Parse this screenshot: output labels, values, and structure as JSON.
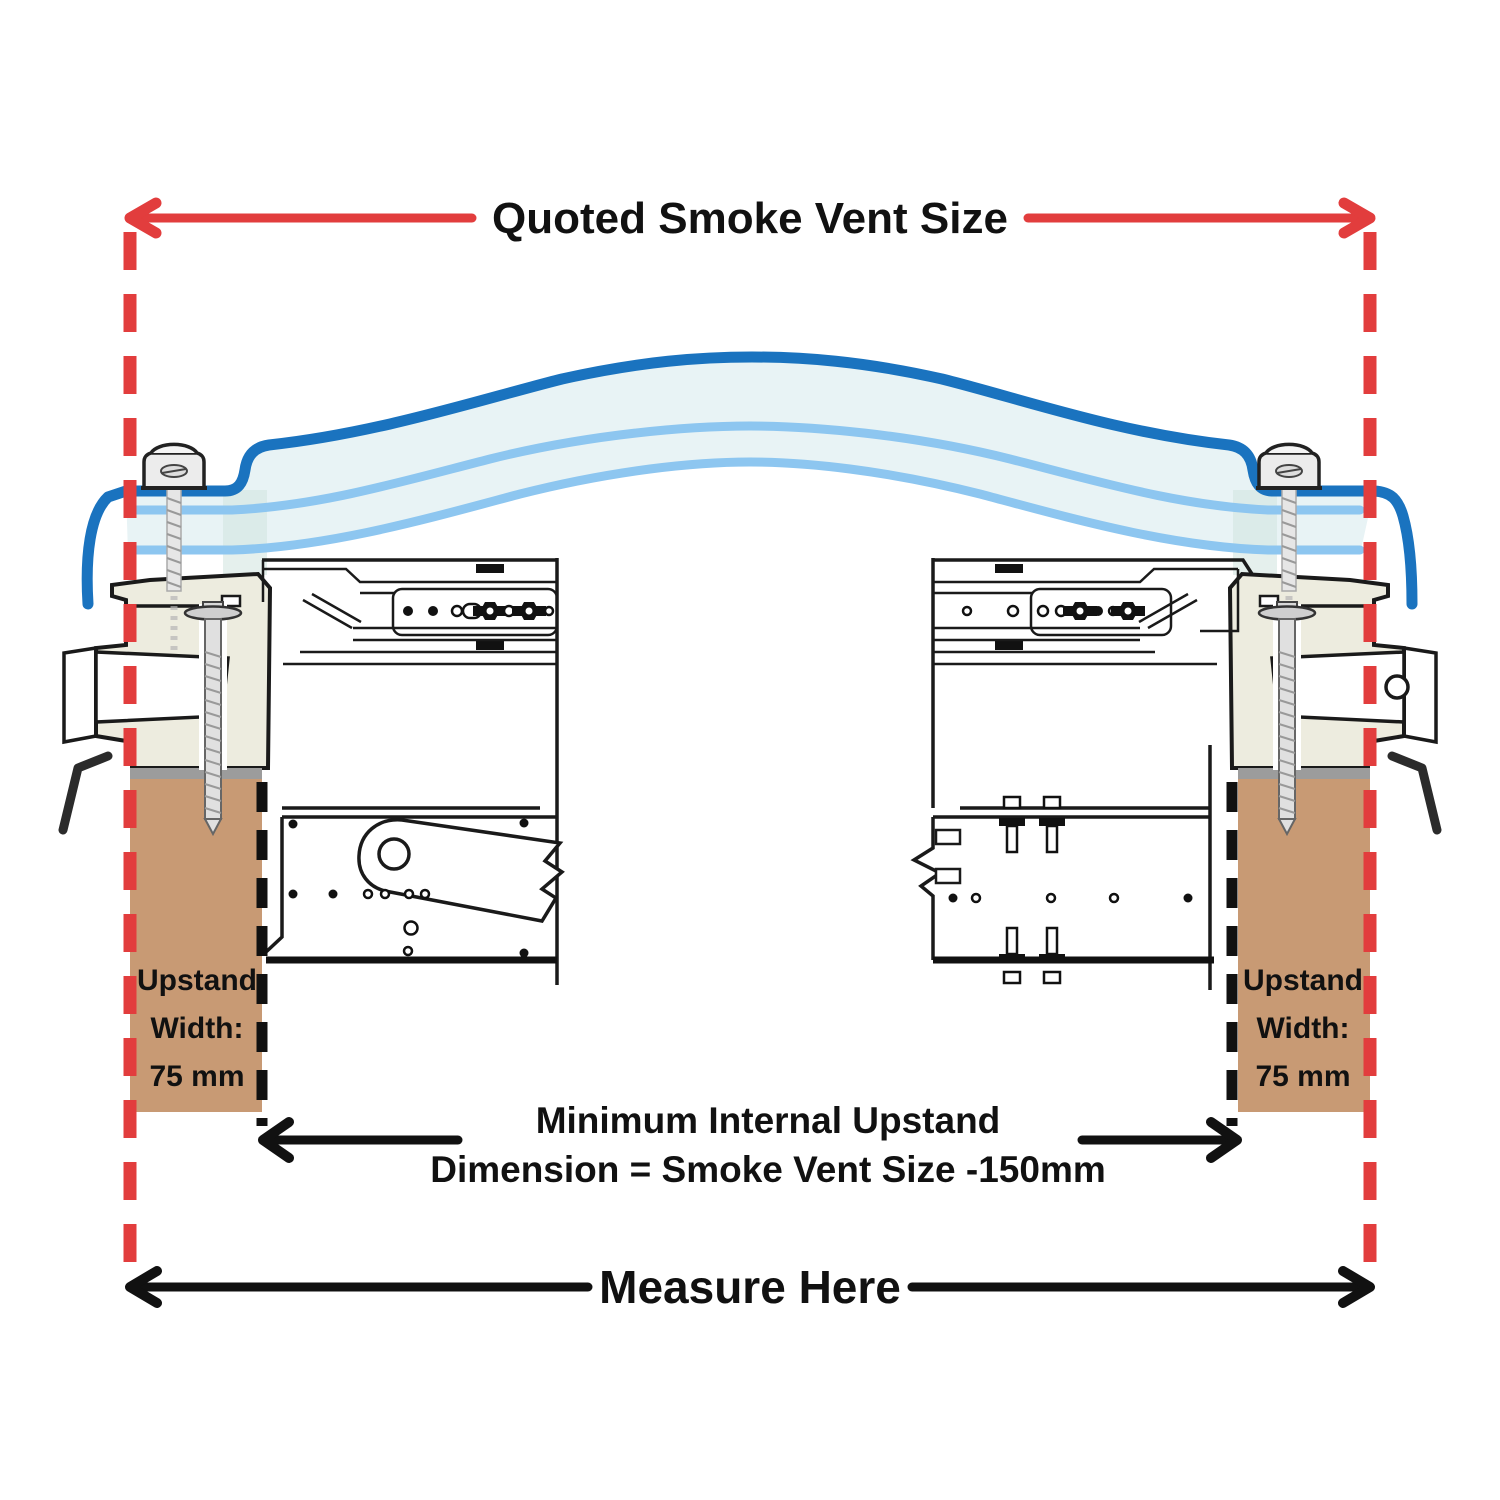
{
  "title": {
    "text": "Quoted Smoke Vent Size"
  },
  "upstand_label": {
    "line1": "Upstand",
    "line2": "Width:",
    "line3": "75 mm"
  },
  "internal_dimension": {
    "line1": "Minimum Internal Upstand",
    "line2": "Dimension = Smoke Vent Size -150mm"
  },
  "measure": {
    "text": "Measure Here"
  },
  "colors": {
    "dimension_red": "#e23d3d",
    "dome_outer_blue": "#1a73bf",
    "glazing_light_blue": "#8dc6f0",
    "glazing_fill": "#e8f3f5",
    "glazing_edge_teal": "#cfe4df",
    "upstand_brown": "#c89a74",
    "frame_cream": "#edecdf",
    "outline_black": "#1a1a1a",
    "sill_gray": "#9c9c9c"
  }
}
